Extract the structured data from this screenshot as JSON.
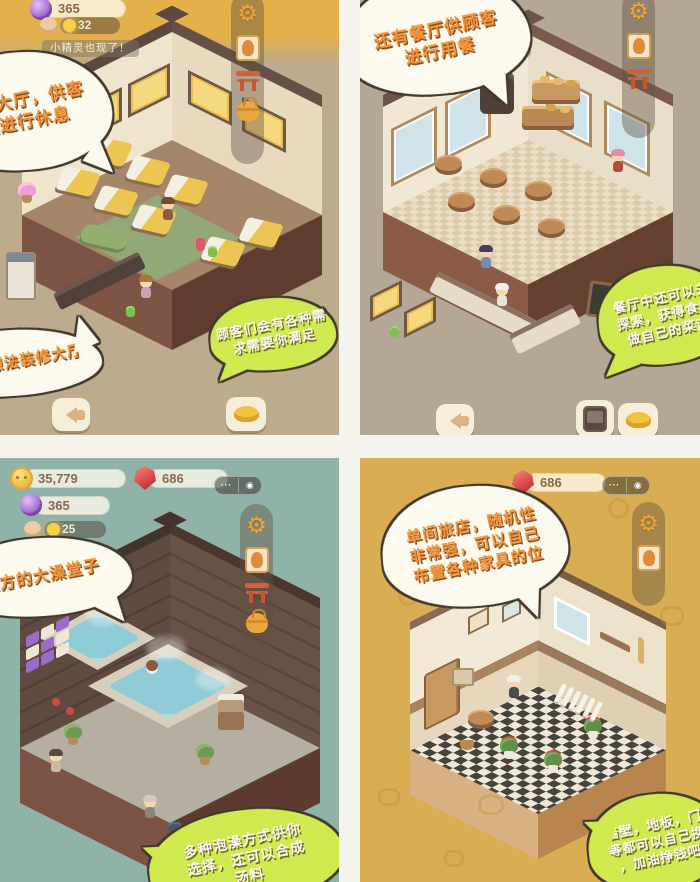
{
  "icons": {
    "gear": "⚙",
    "more": "⋯",
    "record": "◉"
  },
  "colors": {
    "accent_orange": "#e8a23c",
    "bubble_green": "#cfe94f",
    "bubble_text_orange": "#f2953b",
    "bg_rest": "#bcab8d",
    "bg_restaurant": "#b5a796",
    "bg_bath": "#8fb2a9",
    "bg_room": "#d9ad52"
  },
  "panels": {
    "rest_hall": {
      "hud": {
        "purple_gem": "365",
        "lightbulb": "32",
        "toast": "小精灵也现了！"
      },
      "bubbles": {
        "hall": {
          "lines": [
            "休息大厅，供客",
            "人进行休息"
          ]
        },
        "decorate": {
          "lines": [
            "按自己想法装修大厅"
          ]
        },
        "needs": {
          "lines": [
            "顾客们会有各种需",
            "求需要你满足"
          ]
        }
      }
    },
    "restaurant": {
      "hud": {
        "toast": "渔家出现了！"
      },
      "bubbles": {
        "dining": {
          "lines": [
            "还有餐厅供顾客",
            "进行用餐"
          ]
        },
        "explore": {
          "lines": [
            "餐厅中还可以去",
            "探索，获得食材",
            "做自己的菜谱"
          ]
        }
      }
    },
    "bathhouse": {
      "hud": {
        "coin": "35,779",
        "red_gem": "686",
        "purple_gem": "365",
        "lightbulb": "25"
      },
      "bubbles": {
        "bath": {
          "lines": [
            "上方的大澡堂子"
          ]
        },
        "soak": {
          "lines": [
            "多种泡澡方式供你",
            "选择，还可以合成",
            "汤料"
          ]
        }
      }
    },
    "single_room": {
      "hud": {
        "red_gem": "686"
      },
      "bubbles": {
        "intro": {
          "lines": [
            "单间旅店，随机性",
            "非常强，可以自己",
            "布置各种家具的位"
          ]
        },
        "custom": {
          "lines": [
            "墙壁，地板，门",
            "等都可以自己换",
            "，加油挣钱吧"
          ]
        }
      }
    }
  }
}
